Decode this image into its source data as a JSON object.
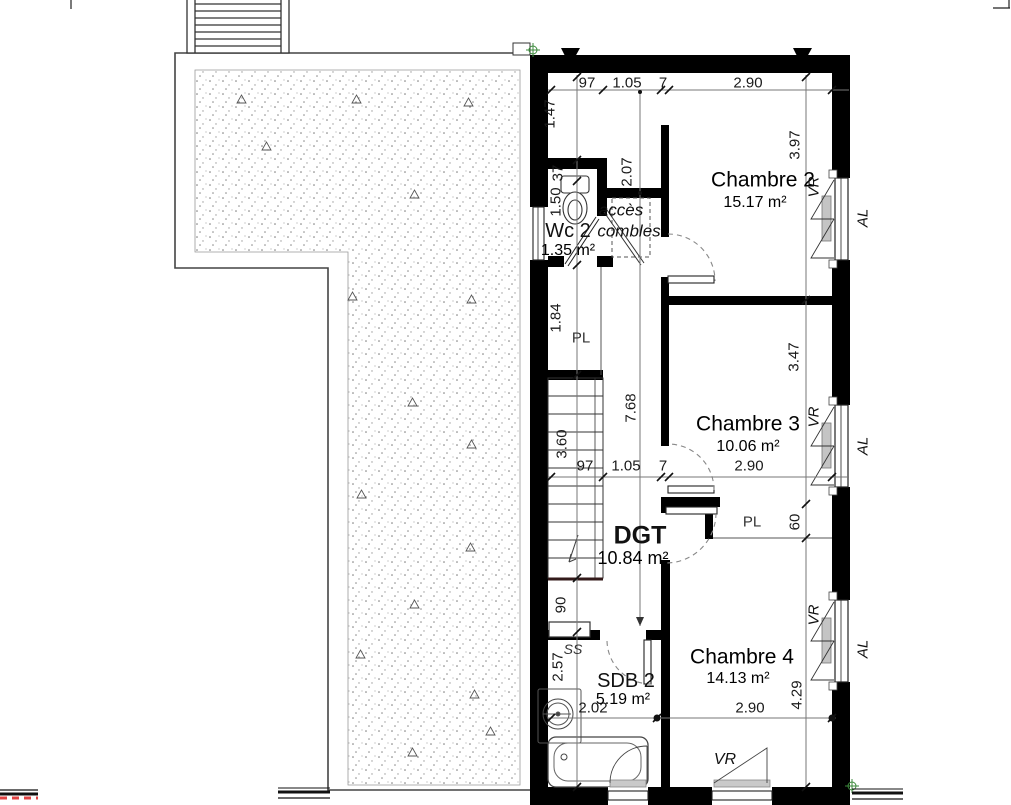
{
  "plan": {
    "rooms": {
      "chambre2": {
        "name": "Chambre 2",
        "area": "15.17 m²"
      },
      "chambre3": {
        "name": "Chambre 3",
        "area": "10.06 m²"
      },
      "chambre4": {
        "name": "Chambre 4",
        "area": "14.13 m²"
      },
      "wc2": {
        "name": "Wc 2",
        "area": "1.35 m²"
      },
      "dgt": {
        "name": "DGT",
        "area": "10.84 m²"
      },
      "sdb2": {
        "name": "SDB 2",
        "area": "5.19 m²"
      }
    },
    "annotations": {
      "acces_line1": "accès",
      "acces_line2": "combles",
      "closet": "PL",
      "towel_rail": "SS",
      "roller_shutter": "VR",
      "aluminium": "AL"
    },
    "dimensions": {
      "w_stair": "97",
      "w_hall": "1.05",
      "w_wall": "7",
      "w_room": "2.90",
      "h_147": "1.47",
      "h_37": "37",
      "h_150": "1.50",
      "h_184": "1.84",
      "h_360": "3.60",
      "h_90": "90",
      "h_257": "2.57",
      "h_397": "3.97",
      "h_347": "3.47",
      "h_60": "60",
      "h_429": "4.29",
      "h_207": "2.07",
      "h_768": "7.68",
      "w_202": "2.02"
    },
    "colors": {
      "wall": "#000000",
      "dim_line": "#777777",
      "section_red": "#e04444",
      "survey_green": "#3c8a3c",
      "shutter_gray": "#c4c4c4"
    }
  }
}
